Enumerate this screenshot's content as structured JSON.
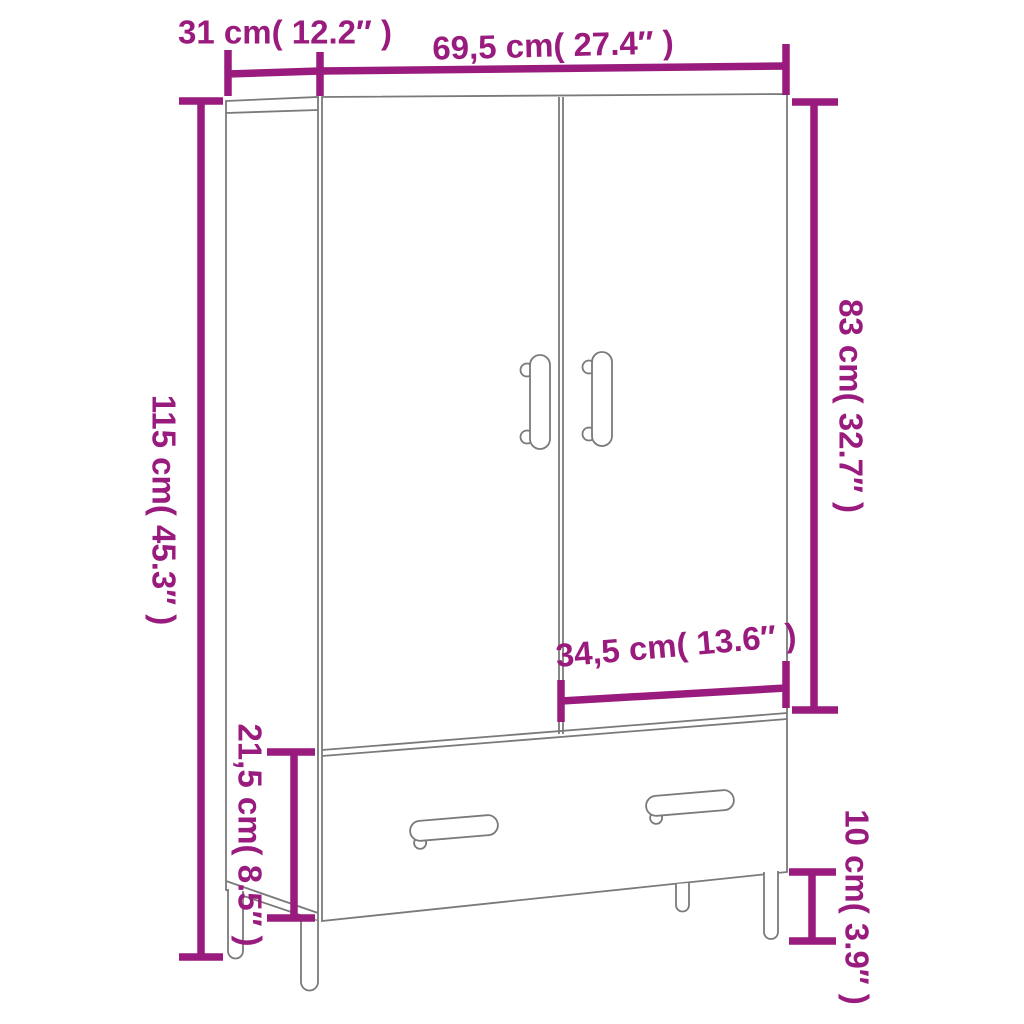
{
  "diagram": {
    "kind": "product-dimension-diagram",
    "product": "wardrobe with two doors, one drawer and legs",
    "accent_color": "#991b7d",
    "outline_color": "#7a7a7a",
    "background_color": "#ffffff",
    "dimensions": {
      "depth": {
        "label": "31 cm( 12.2″ )",
        "cm": "31",
        "inches": "12.2"
      },
      "width": {
        "label": "69,5 cm( 27.4″ )",
        "cm": "69,5",
        "inches": "27.4"
      },
      "height": {
        "label": "115 cm( 45.3″ )",
        "cm": "115",
        "inches": "45.3"
      },
      "door_height": {
        "label": "83 cm( 32.7″ )",
        "cm": "83",
        "inches": "32.7"
      },
      "door_width": {
        "label": "34,5 cm( 13.6″ )",
        "cm": "34,5",
        "inches": "13.6"
      },
      "drawer_height": {
        "label": "21,5 cm( 8.5″ )",
        "cm": "21,5",
        "inches": "8.5"
      },
      "leg_height": {
        "label": "10 cm( 3.9″ )",
        "cm": "10",
        "inches": "3.9"
      }
    }
  }
}
